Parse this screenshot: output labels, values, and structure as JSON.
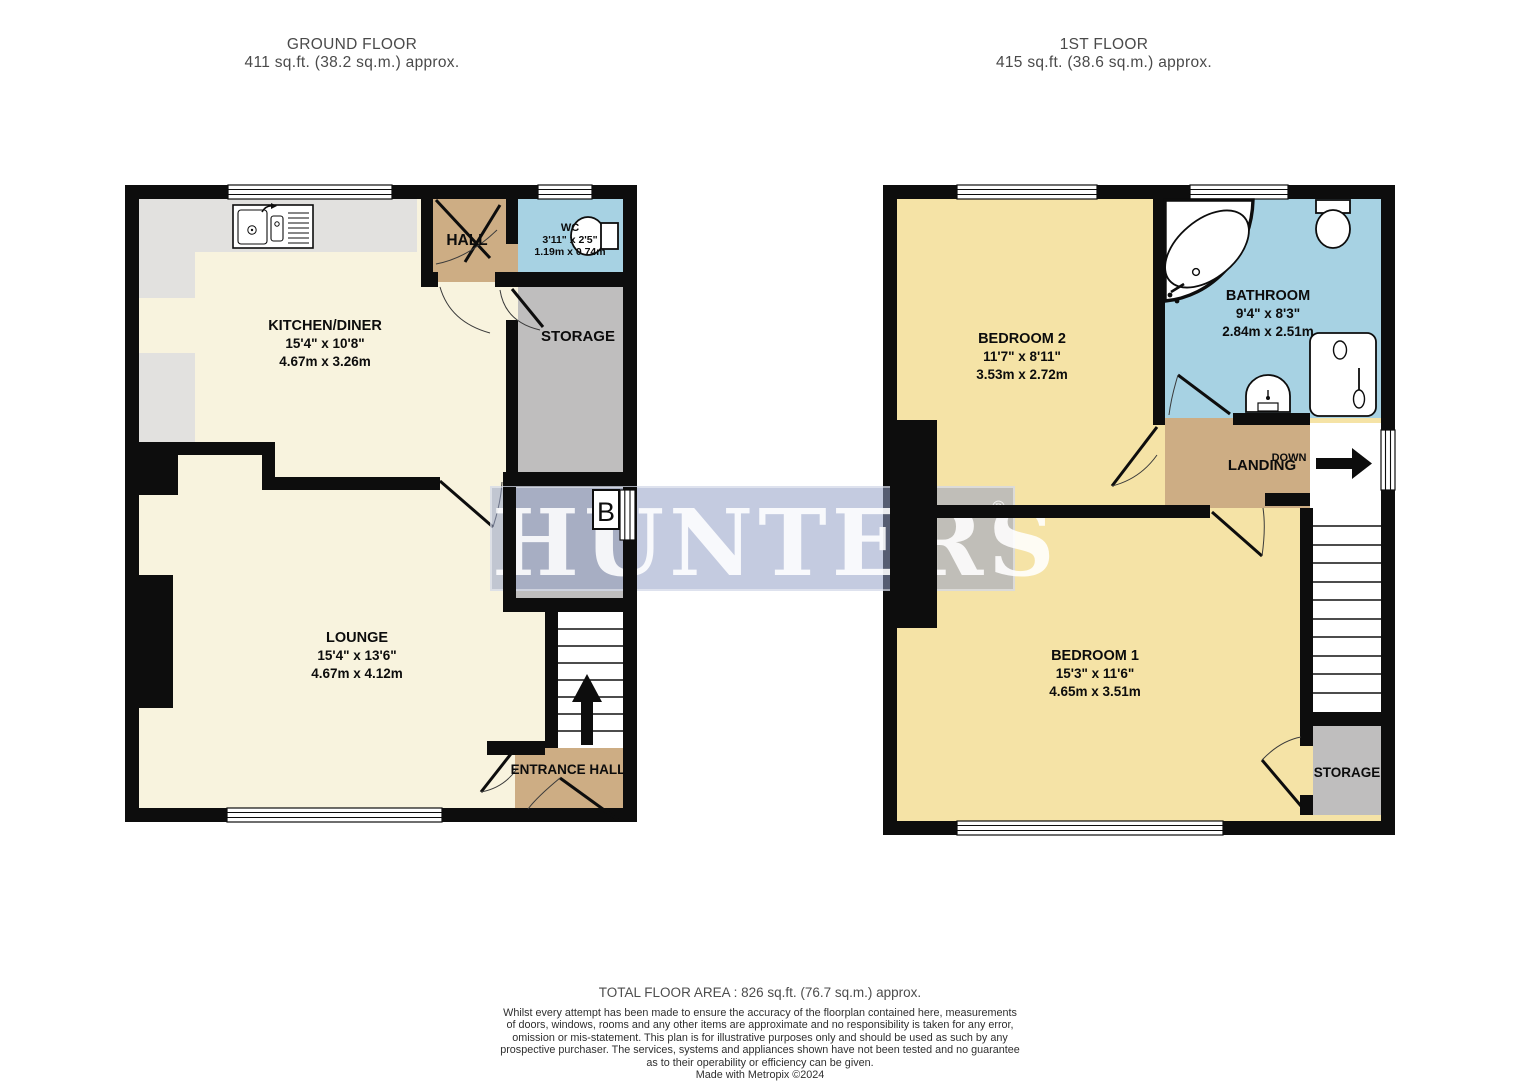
{
  "ground": {
    "title": "GROUND FLOOR",
    "subtitle": "411 sq.ft. (38.2 sq.m.) approx.",
    "kitchen": {
      "name": "KITCHEN/DINER",
      "imperial": "15'4\"  x 10'8\"",
      "metric": "4.67m  x 3.26m"
    },
    "hall": {
      "name": "HALL"
    },
    "wc": {
      "name": "WC",
      "imperial": "3'11\"  x 2'5\"",
      "metric": "1.19m  x 0.74m"
    },
    "storage_top": {
      "name": "STORAGE"
    },
    "storage_mid": {
      "name": "STORAGE"
    },
    "lounge": {
      "name": "LOUNGE",
      "imperial": "15'4\"  x 13'6\"",
      "metric": "4.67m  x 4.12m"
    },
    "entrance": {
      "name": "ENTRANCE HALL"
    },
    "boiler": "B"
  },
  "first": {
    "title": "1ST FLOOR",
    "subtitle": "415 sq.ft. (38.6 sq.m.) approx.",
    "bedroom2": {
      "name": "BEDROOM 2",
      "imperial": "11'7\"  x 8'11\"",
      "metric": "3.53m  x 2.72m"
    },
    "bathroom": {
      "name": "BATHROOM",
      "imperial": "9'4\"  x 8'3\"",
      "metric": "2.84m  x 2.51m"
    },
    "landing": {
      "name": "LANDING",
      "down": "DOWN"
    },
    "bedroom1": {
      "name": "BEDROOM 1",
      "imperial": "15'3\"  x 11'6\"",
      "metric": "4.65m  x 3.51m"
    },
    "storage": {
      "name": "STORAGE"
    }
  },
  "watermark": {
    "text": "HUNTERS",
    "reg": "®"
  },
  "footer": {
    "total": "TOTAL FLOOR AREA : 826 sq.ft. (76.7 sq.m.) approx.",
    "disclaimer": [
      "Whilst every attempt has been made to ensure the accuracy of the floorplan contained here, measurements",
      "of doors, windows, rooms and any other items are approximate and no responsibility is taken for any error,",
      "omission or mis-statement. This plan is for illustrative purposes only and should be used as such by any",
      "prospective purchaser. The services, systems and appliances shown have not been tested and no guarantee",
      "as to their operability or efficiency can be given.",
      "Made with Metropix ©2024"
    ]
  },
  "colors": {
    "wall": "#0d0d0d",
    "cream": "#f8f3de",
    "bedroom_yellow": "#f5e3a6",
    "hall_tan": "#cdad84",
    "bath_blue": "#a7d2e3",
    "storage_gray": "#bfbebe",
    "counter_gray": "#e2e1df",
    "watermark_band": "#94a1c6"
  }
}
